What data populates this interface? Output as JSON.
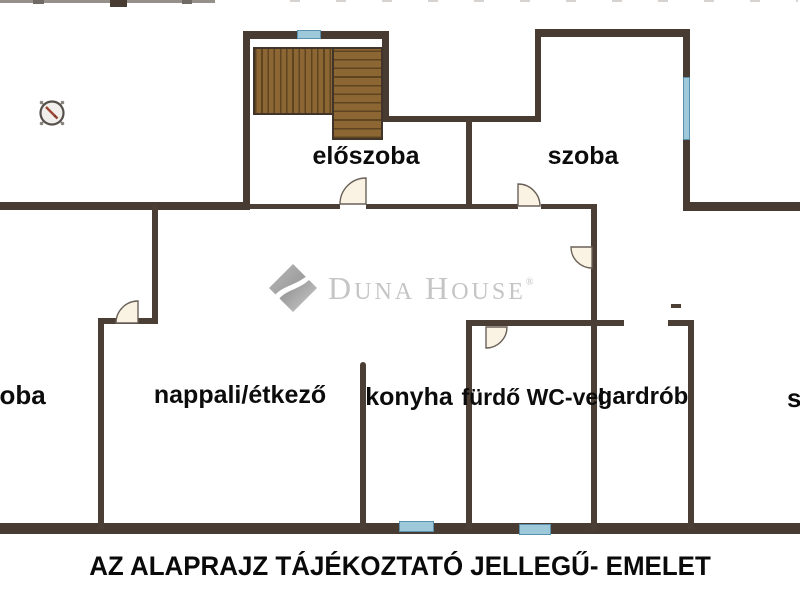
{
  "rooms": {
    "eloszoba": "előszoba",
    "szoba_top": "szoba",
    "szoba_left": "szoba",
    "szoba_right": "szoba",
    "nappali": "nappali/étkező",
    "konyha": "konyha",
    "furdo": "fürdő WC-vel",
    "gardrob": "gardrób"
  },
  "watermark": {
    "d": "D",
    "una": "UNA",
    "h": "H",
    "ouse": "OUSE",
    "reg": "®"
  },
  "caption": "AZ ALAPRAJZ TÁJÉKOZTATÓ JELLEGŰ- EMELET",
  "icons": {
    "compass": "compass-icon",
    "window": "window-marker",
    "door": "door-swing-arc"
  },
  "colors": {
    "wall": "#473b32",
    "window_blue": "#9ec9da",
    "window_edge": "#5a92ae",
    "stairs_brown": "#8c6633",
    "stair_line": "#5e441f",
    "door_fill": "#faf3e4",
    "watermark_gray": "#c5c5c5",
    "label_black": "#0c0c0c"
  }
}
